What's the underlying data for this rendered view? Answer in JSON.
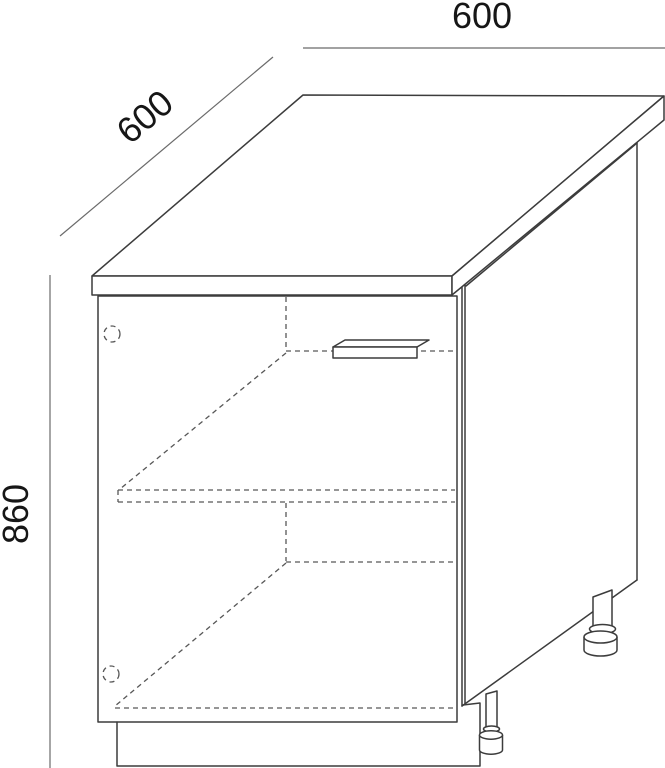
{
  "diagram": {
    "dimension_labels": {
      "width": "600",
      "depth": "600",
      "height": "860"
    },
    "colors": {
      "line": "#3c3c3c",
      "hidden": "#575757",
      "dim": "#6b6b6b",
      "text": "#161616",
      "background": "#ffffff"
    }
  }
}
